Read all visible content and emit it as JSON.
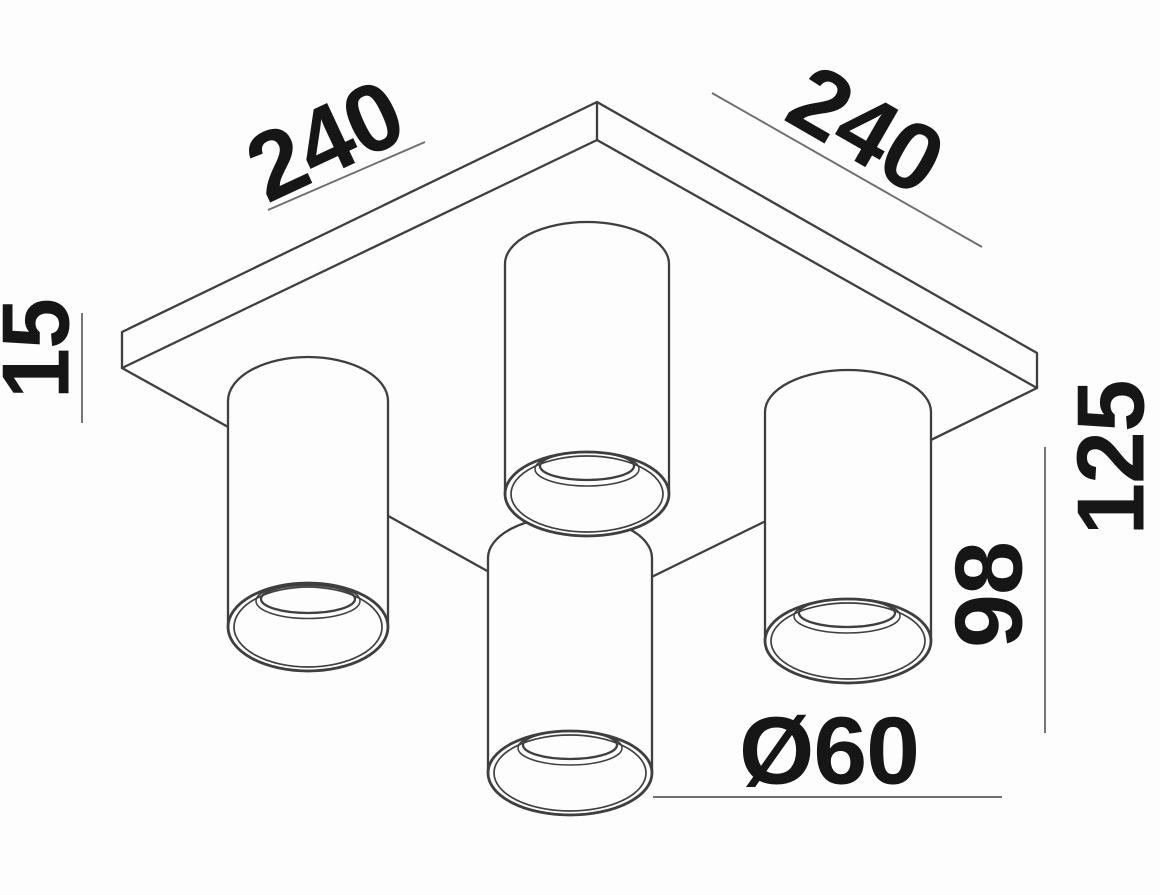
{
  "meta": {
    "title": "Ceiling spotlight fixture — dimensioned technical drawing",
    "drawing_type": "axonometric line drawing, viewed from below",
    "units": "mm",
    "parts": {
      "mounting_plate": "square canopy plate",
      "spotlights": "4 cylindrical downlight tubes with recessed openings"
    }
  },
  "labels": {
    "plate_width": "240",
    "plate_depth": "240",
    "plate_thickness": "15",
    "overall_height": "125",
    "cylinder_height": "98",
    "cylinder_diameter": "Ø60"
  },
  "colors": {
    "background": "#fdfdfd",
    "geometry_line": "#3f3f3f",
    "dimension_line": "#6e6e6e",
    "text": "#161616"
  }
}
